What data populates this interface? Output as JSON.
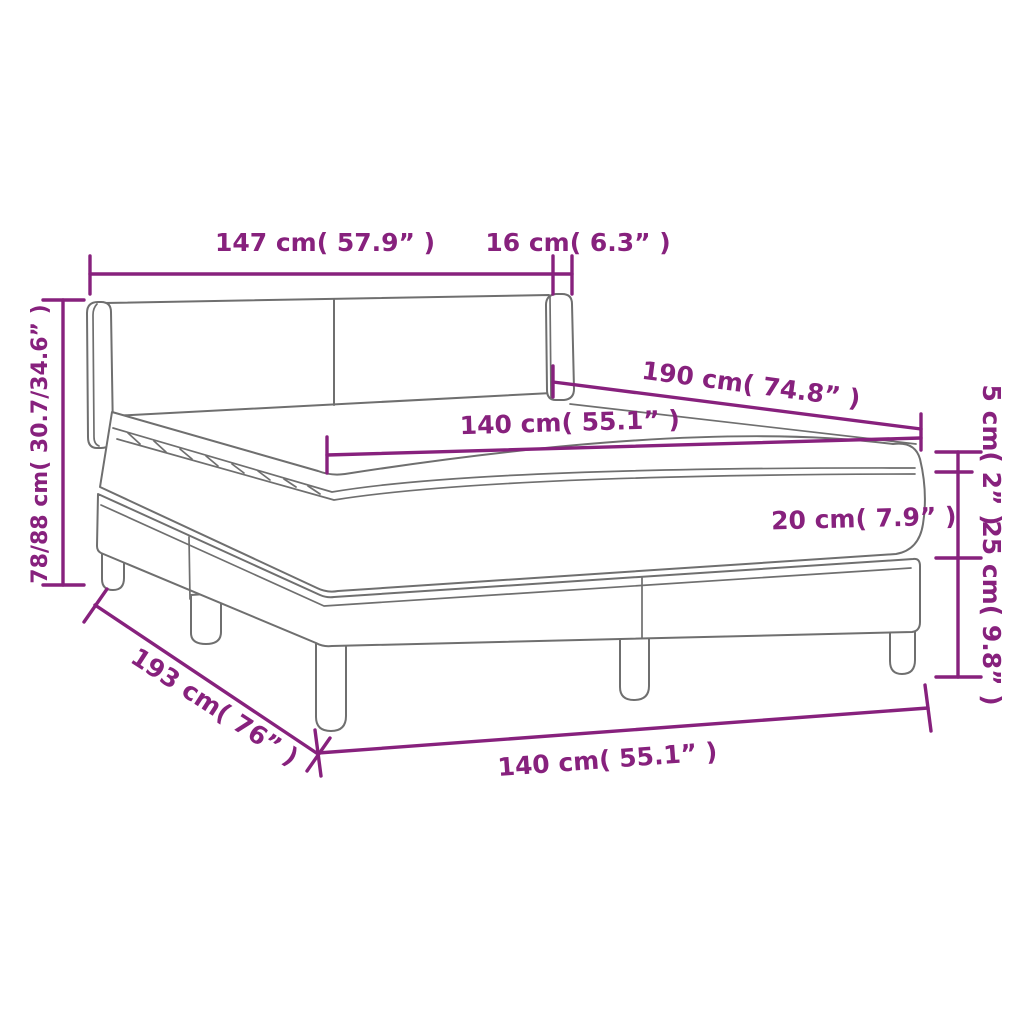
{
  "diagram": {
    "type": "product-dimension-diagram",
    "subject": "box spring bed with headboard, mattress and topper",
    "colors": {
      "dimension_accent": "#87217D",
      "line_art": "#6F6F6F",
      "background": "#FFFFFF"
    },
    "labels": {
      "headboard_width": "147 cm( 57.9” )",
      "wing_depth": "16 cm( 6.3” )",
      "total_height": "78/88 cm( 30.7/34.6” )",
      "mattress_length": "190 cm( 74.8” )",
      "mattress_width": "140 cm( 55.1” )",
      "topper_height": "5 cm( 2” )",
      "mattress_height": "20 cm( 7.9” )",
      "base_height": "25 cm( 9.8” )",
      "base_length": "193 cm( 76” )",
      "base_width": "140 cm( 55.1” )"
    }
  }
}
